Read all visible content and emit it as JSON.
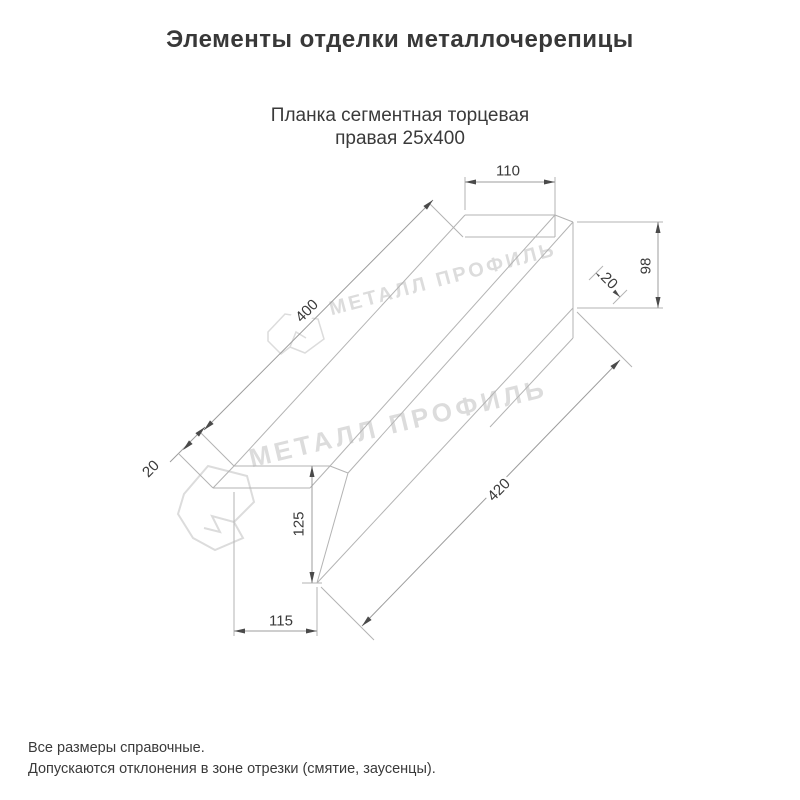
{
  "page": {
    "title": "Элементы отделки металлочерепицы",
    "subtitle_line1": "Планка сегментная торцевая",
    "subtitle_line2": "правая 25х400"
  },
  "drawing": {
    "type": "axonometric-wireframe",
    "product": "Планка сегментная торцевая правая 25х400",
    "dims": {
      "top_end_width": "110",
      "flange_length": "400",
      "left_end_fold": "20",
      "right_end_height": "98",
      "right_fold": "20",
      "side_length": "420",
      "left_end_height": "125",
      "left_end_width": "115"
    }
  },
  "watermark": {
    "text": "МЕТАЛЛ ПРОФИЛЬ",
    "logo": "metall-profil-logo",
    "color": "#dcdcdc"
  },
  "footnotes": {
    "line1": "Все размеры справочные.",
    "line2": "Допускаются отклонения в зоне отрезки (смятие, заусенцы)."
  },
  "colors": {
    "background": "#ffffff",
    "text": "#3a3a3a",
    "part_line": "#b3b3b3",
    "dimension_line": "#9c9c9c",
    "arrow": "#4a4a4a"
  }
}
